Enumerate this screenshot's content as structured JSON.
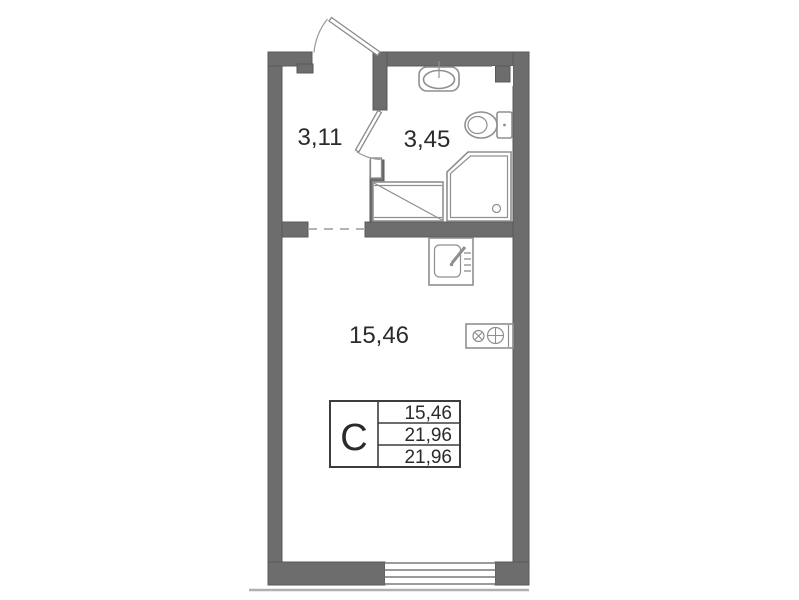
{
  "floor_plan": {
    "rooms": {
      "hallway": {
        "area": "3,11"
      },
      "bathroom": {
        "area": "3,45"
      },
      "living_room": {
        "area": "15,46"
      }
    },
    "legend": {
      "unit_type": "С",
      "living_area": "15,46",
      "apartment_area": "21,96",
      "total_area": "21,96"
    },
    "fixtures": [
      "entrance-door",
      "interior-door",
      "washbasin",
      "toilet",
      "shower-cabin",
      "washing-machine",
      "kitchen-sink",
      "stove",
      "window",
      "open-doorway",
      "vent-shaft"
    ],
    "colors": {
      "wall": "#6d6d6d",
      "fixture_line": "#8f8f8f",
      "text": "#2b2b2b",
      "background": "#ffffff"
    }
  }
}
